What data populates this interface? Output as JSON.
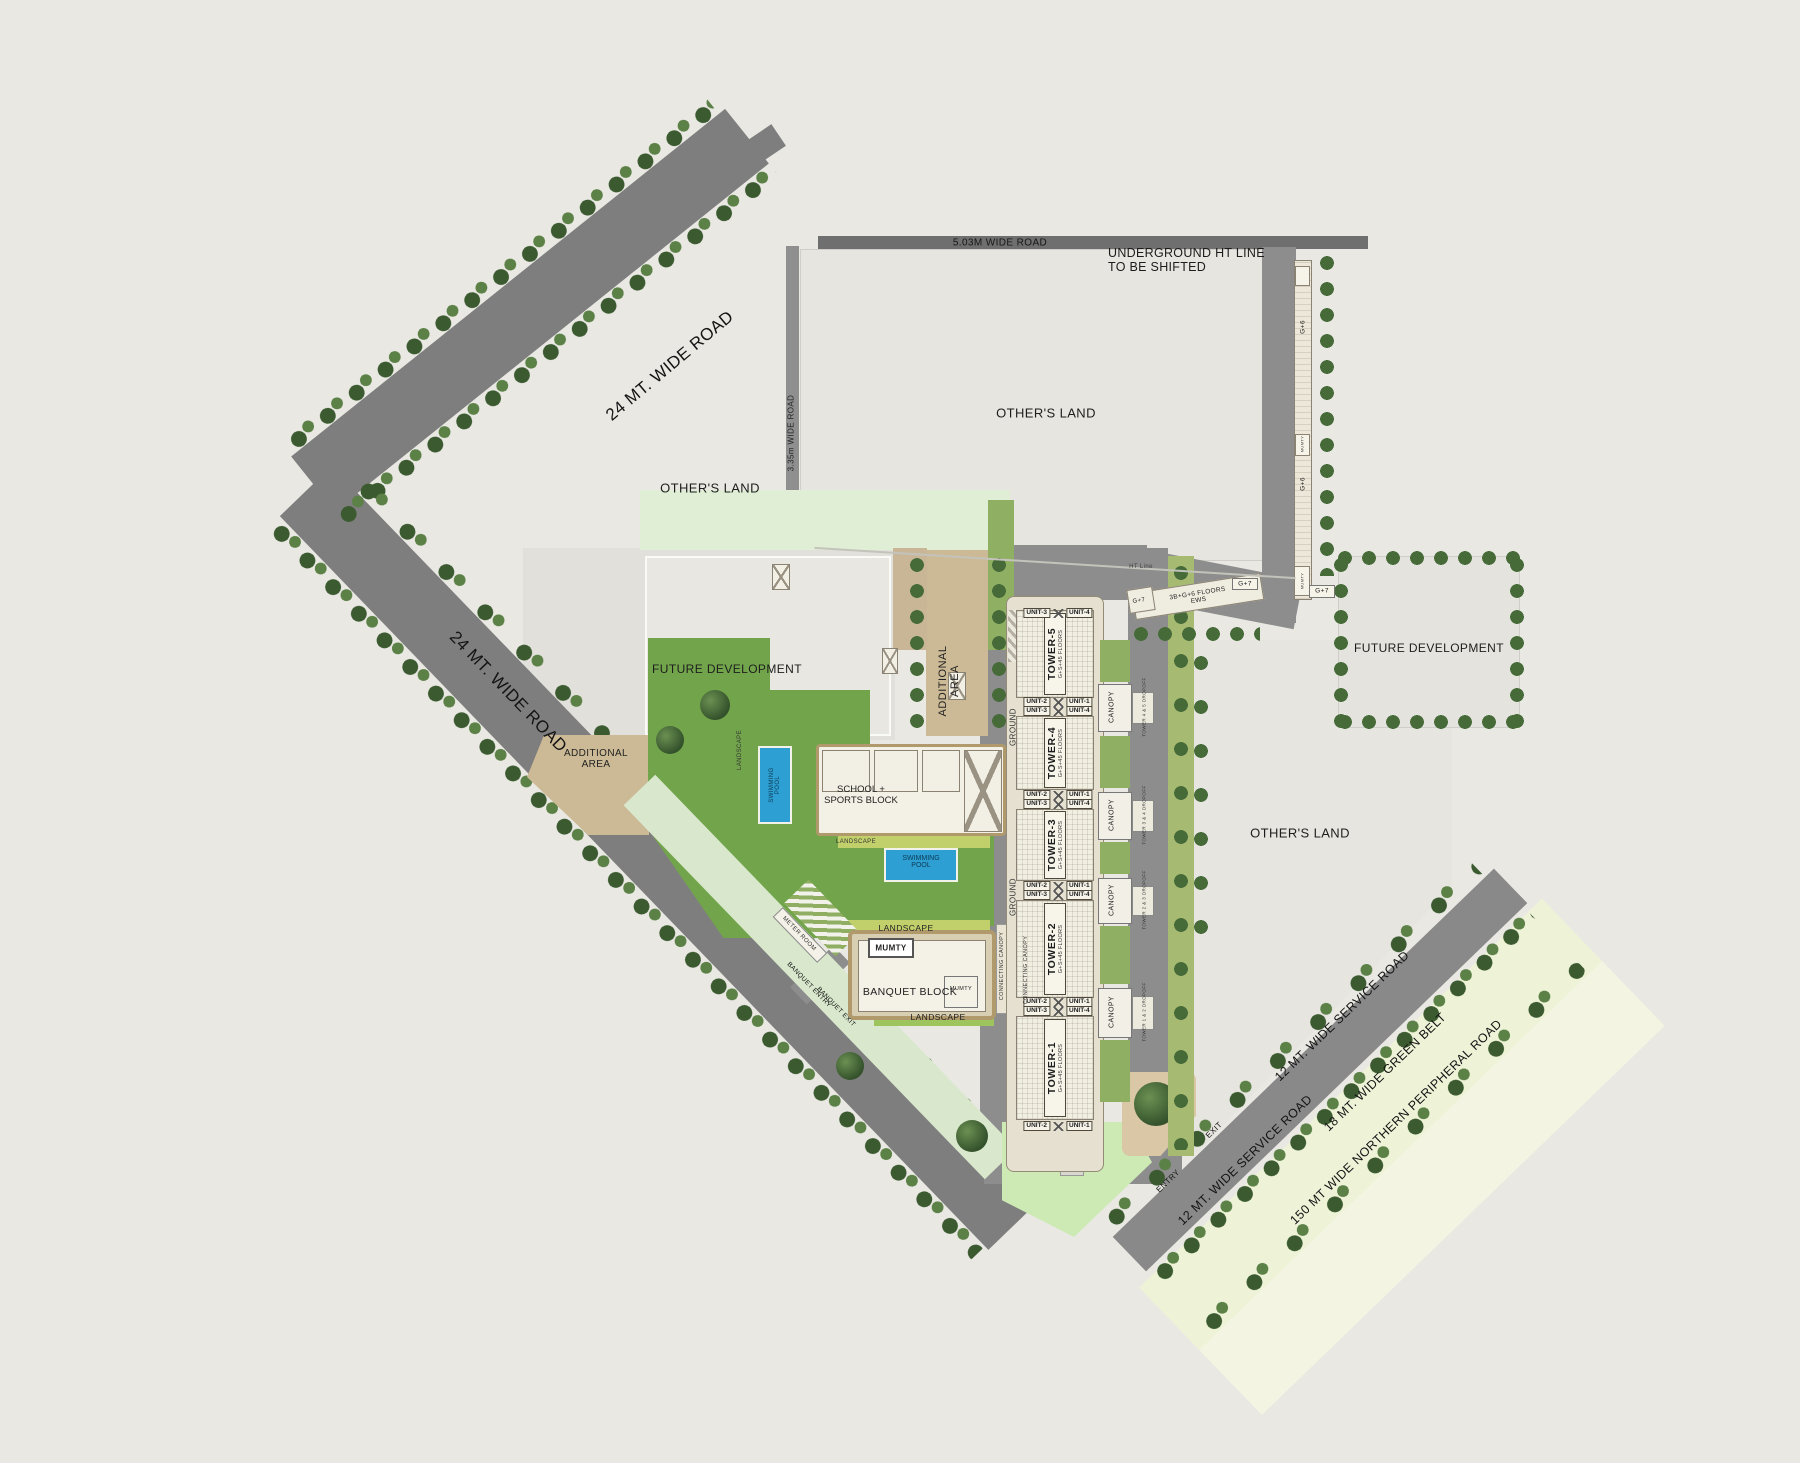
{
  "colors": {
    "background": "#e9e8e3",
    "road": "#7e7e7e",
    "lawn": "#72a54b",
    "pool": "#2d9fd2",
    "additional_area": "#ccba96",
    "green_belt": "#eef3d8",
    "tree_dark": "#3b5a30"
  },
  "roads": {
    "top_road": "5.03M WIDE ROAD",
    "nw_road": "24 MT. WIDE ROAD",
    "sw_road": "24 MT. WIDE ROAD",
    "lane_road": "3.35m WIDE ROAD",
    "service_road": "12 MT. WIDE SERVICE ROAD",
    "green_belt": "18 MT. WIDE GREEN BELT",
    "peripheral_road": "150 MT WIDE NORTHERN PERIPHERAL ROAD"
  },
  "notes": {
    "underground_line1": "UNDERGROUND HT LINE",
    "underground_line2": "TO BE SHIFTED",
    "ht_line": "HT Line"
  },
  "parcels": {
    "others_land": "OTHER'S LAND",
    "future_development": "FUTURE DEVELOPMENT",
    "additional_line1": "ADDITIONAL",
    "additional_line2": "AREA"
  },
  "site": {
    "school_line1": "SCHOOL +",
    "school_line2": "SPORTS BLOCK",
    "swimming_line1": "SWIMMING",
    "swimming_line2": "POOL",
    "banquet_block": "BANQUET BLOCK",
    "mumty": "MUMTY",
    "landscape": "LANDSCAPE",
    "meter_room": "METER ROOM",
    "ground": "GROUND",
    "connecting_canopy": "CONNECTING CANOPY"
  },
  "access": {
    "entry": "ENTRY",
    "exit": "EXIT",
    "banquet_entry": "BANQUET ENTRY",
    "banquet_exit": "BANQUET EXIT"
  },
  "towers": [
    {
      "name": "TOWER-5",
      "floors": "G+S+45 FLOORS"
    },
    {
      "name": "TOWER-4",
      "floors": "G+S+45 FLOORS"
    },
    {
      "name": "TOWER-3",
      "floors": "G+S+45 FLOORS"
    },
    {
      "name": "TOWER-2",
      "floors": "G+S+45 FLOORS"
    },
    {
      "name": "TOWER-1",
      "floors": "G+S+45 FLOORS"
    }
  ],
  "units": {
    "u1": "UNIT-1",
    "u2": "UNIT-2",
    "u3": "UNIT-3",
    "u4": "UNIT-4"
  },
  "canopies": [
    {
      "label": "CANOPY",
      "dropoff": "TOWER 4 & 5 DROPOFF"
    },
    {
      "label": "CANOPY",
      "dropoff": "TOWER 3 & 4 DROPOFF"
    },
    {
      "label": "CANOPY",
      "dropoff": "TOWER 2 & 3 DROPOFF"
    },
    {
      "label": "CANOPY",
      "dropoff": "TOWER 1 & 2 DROPOFF"
    }
  ],
  "ews": {
    "line1": "3B+G+6 FLOORS",
    "line2": "EWS",
    "g6": "G+6",
    "g7": "G+7"
  }
}
